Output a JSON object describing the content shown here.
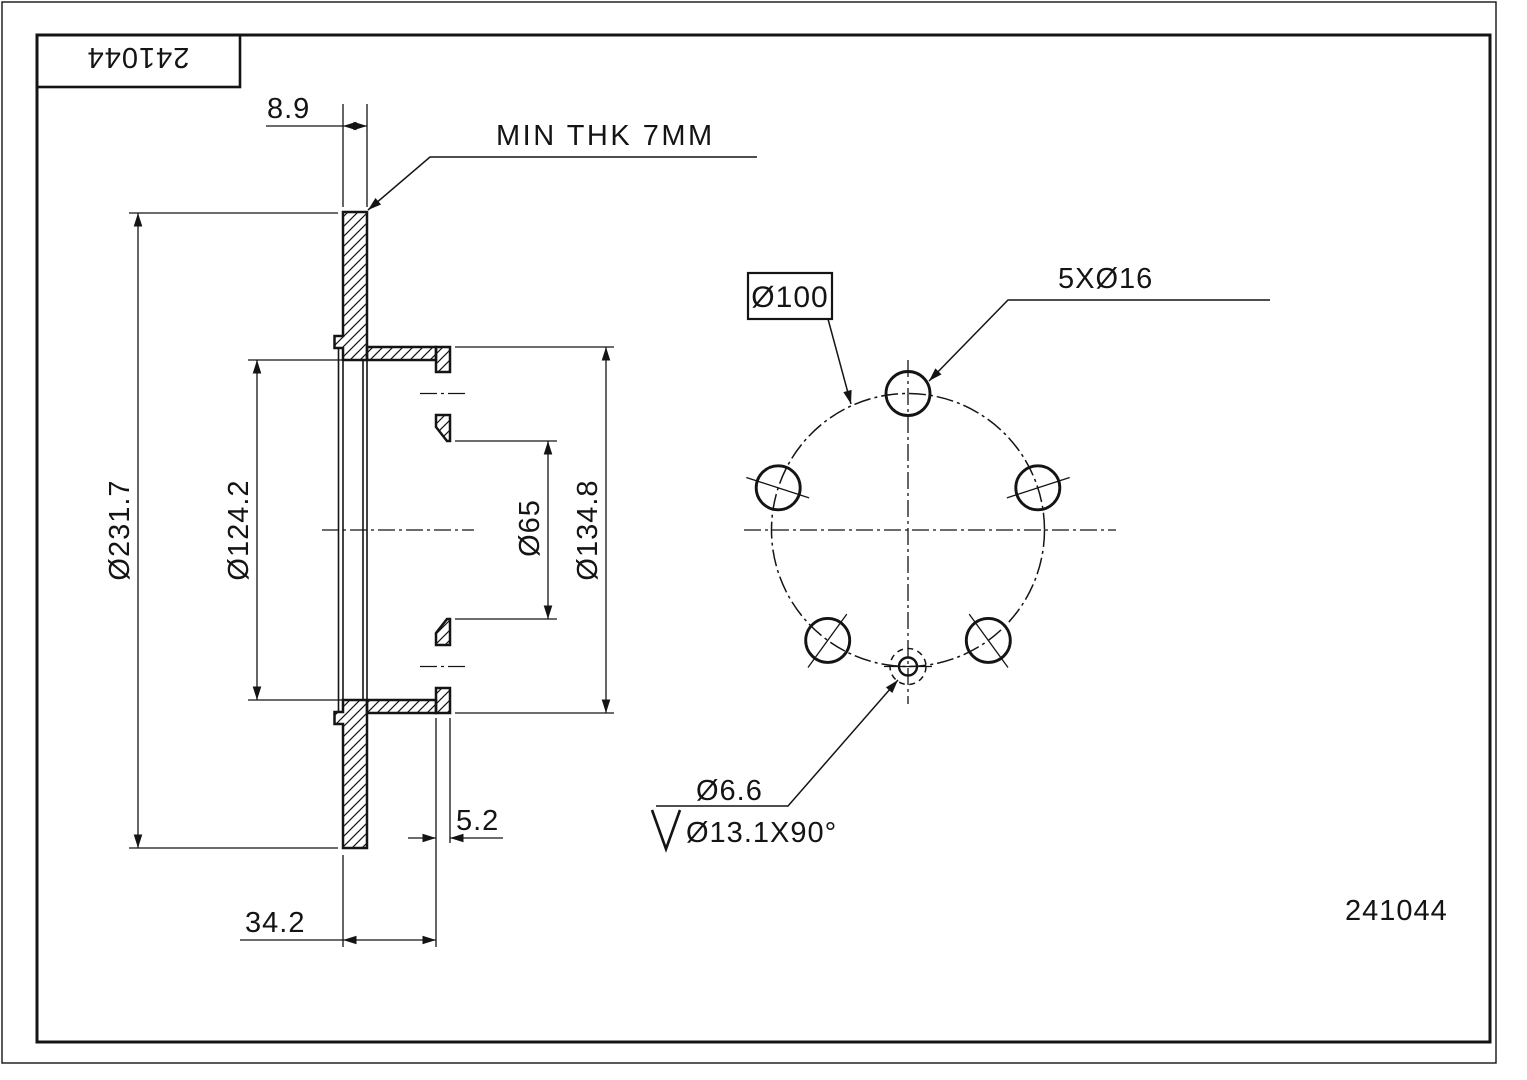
{
  "drawing": {
    "colors": {
      "line": "#141414",
      "background": "#ffffff"
    },
    "title_block": {
      "part_number": "241044"
    },
    "footer": {
      "part_number": "241044"
    },
    "section_view": {
      "dim_thickness": "8.9",
      "note_min_thickness": "MIN THK 7MM",
      "dim_outer_diameter": "Ø231.7",
      "dim_hat_inner_diameter": "Ø124.2",
      "dim_center_bore": "Ø65",
      "dim_flange_diameter": "Ø134.8",
      "dim_flange_thickness": "5.2",
      "dim_overall_width": "34.2"
    },
    "face_view": {
      "dim_bolt_circle": "Ø100",
      "dim_bolt_holes": "5XØ16",
      "dim_locating_hole": "Ø6.6",
      "dim_countersink": "Ø13.1X90°"
    }
  }
}
